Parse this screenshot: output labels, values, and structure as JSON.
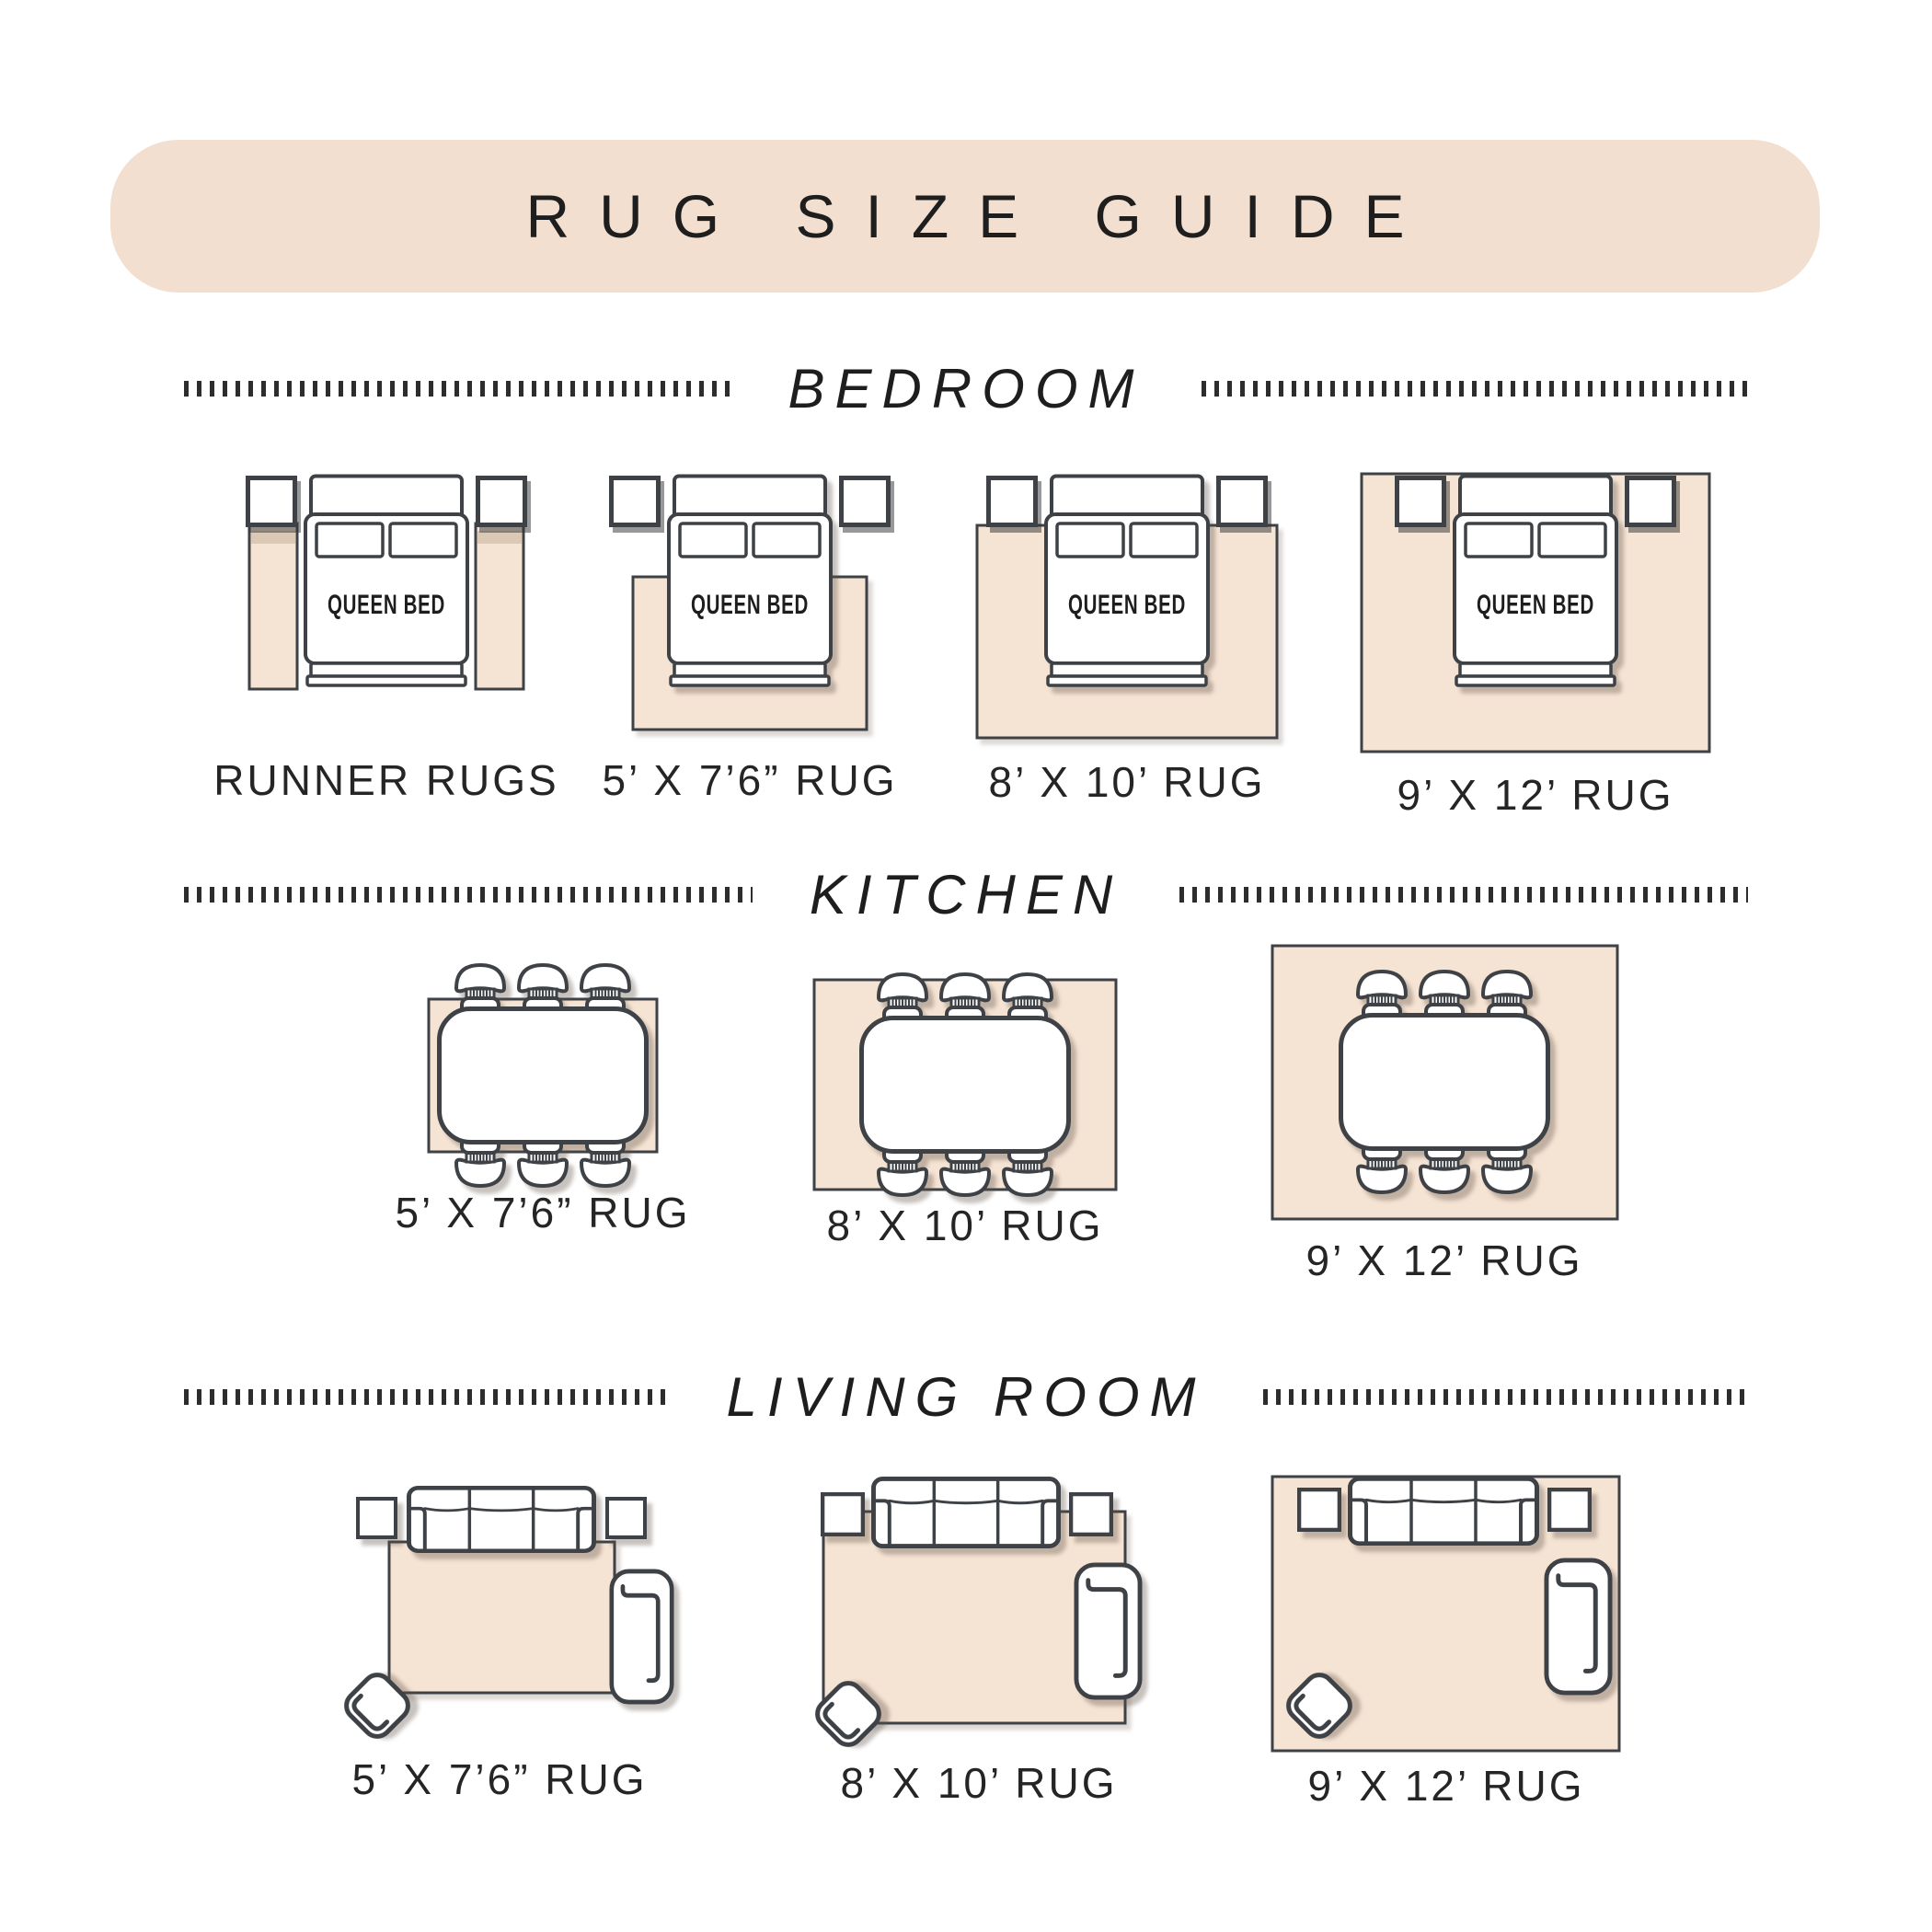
{
  "header": {
    "title": "RUG SIZE GUIDE"
  },
  "bed_label": "QUEEN BED",
  "sections": {
    "bedroom": {
      "title": "BEDROOM",
      "items": [
        {
          "label": "RUNNER RUGS"
        },
        {
          "label": "5’ X 7’6” RUG"
        },
        {
          "label": "8’ X 10’ RUG"
        },
        {
          "label": "9’ X 12’ RUG"
        }
      ]
    },
    "kitchen": {
      "title": "KITCHEN",
      "items": [
        {
          "label": "5’ X 7’6” RUG"
        },
        {
          "label": "8’ X 10’ RUG"
        },
        {
          "label": "9’ X 12’ RUG"
        }
      ]
    },
    "living_room": {
      "title": "LIVING ROOM",
      "items": [
        {
          "label": "5’ X 7’6” RUG"
        },
        {
          "label": "8’ X 10’ RUG"
        },
        {
          "label": "9’ X 12’ RUG"
        }
      ]
    }
  },
  "colors": {
    "banner_background": "#f2dfcf",
    "rug_fill": "#f5e3d3",
    "outline": "#3e4246",
    "text": "#1e1e1e"
  }
}
